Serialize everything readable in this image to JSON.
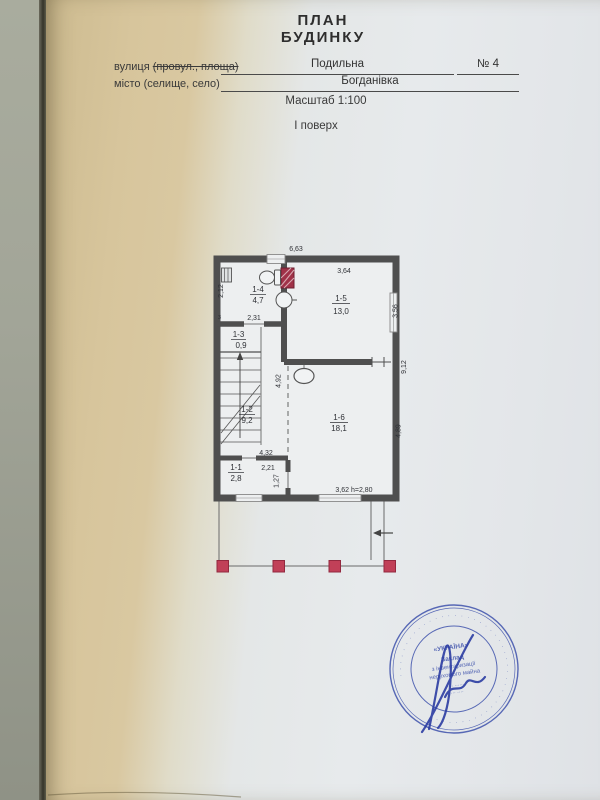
{
  "header": {
    "title_line1": "ПЛАН",
    "title_line2": "БУДИНКУ"
  },
  "form": {
    "street_label_prefix": "вулиця",
    "street_label_struck": "(провул., площа)",
    "street_value": "Подильна",
    "house_number": "№ 4",
    "city_label": "місто (селище, село)",
    "city_value": "Богданівка",
    "scale_label": "Масштаб 1:100",
    "floor_label": "І поверх"
  },
  "plan": {
    "rooms": [
      {
        "number": "1-1",
        "area": "2,8"
      },
      {
        "number": "1-2",
        "area": "9,2"
      },
      {
        "number": "1-3",
        "area": "0,9"
      },
      {
        "number": "1-4",
        "area": "4,7"
      },
      {
        "number": "1-5",
        "area": "13,0"
      },
      {
        "number": "1-6",
        "area": "18,1"
      }
    ],
    "dimensions": {
      "overall_width": "6,63",
      "room5_width": "3,64",
      "room5_depth": "3,56",
      "right_side_depth": "9,12",
      "room4_depth": "2,12",
      "room4_width": "2,31",
      "stair_hall_depth": "4,92",
      "room6_depth": "4,89",
      "room2_width": "4,32",
      "vestibule_width": "2,21",
      "vestibule_depth": "1,27",
      "room6_width_and_height": "3,62  h=2,80",
      "corner_mark": "з"
    }
  },
  "stamp": {
    "country": "«УКРАЇНА»",
    "center_line1": "Заклад",
    "center_line2": "з інвентаризації",
    "center_line3": "нерухомого майна",
    "small_line1": "···· ·······",
    "small_line2": "··· ····",
    "ring_text": "· · · · · · · · · · · · · · · · · · · · · · · · · · · · · · · · · · · · · · · · · · · ·"
  },
  "colors": {
    "wall": "#4f4f4f",
    "porch_column": "#c14058",
    "vent_shaft": "#a03248",
    "stamp_blue": "#4457ae",
    "paper_shadow_tan": "#d6c49a",
    "paper": "#e6e9eb",
    "background": "#a2a598"
  }
}
